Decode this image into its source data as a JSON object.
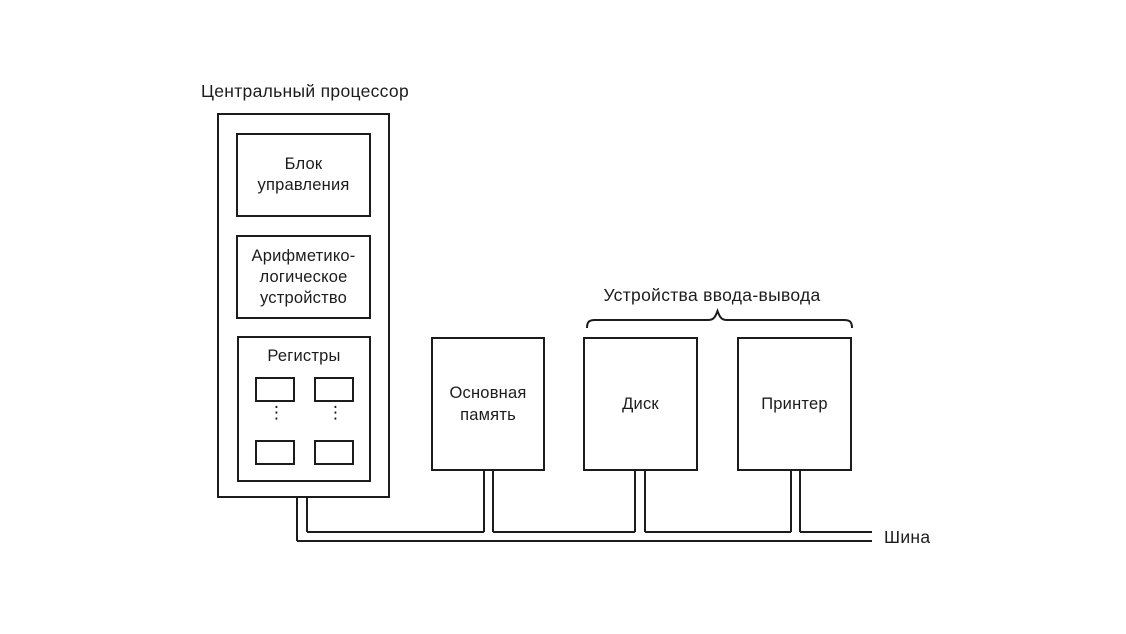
{
  "colors": {
    "ink": "#1c1c1c",
    "background": "#ffffff"
  },
  "cpu": {
    "title": "Центральный процессор",
    "control_unit": {
      "line1": "Блок",
      "line2": "управления"
    },
    "alu": {
      "line1": "Арифметико-",
      "line2": "логическое",
      "line3": "устройство"
    },
    "registers": {
      "title": "Регистры",
      "ellipsis_glyph": "⋮"
    }
  },
  "memory": {
    "line1": "Основная",
    "line2": "память"
  },
  "io_devices": {
    "group_label": "Устройства ввода-вывода",
    "disk_label": "Диск",
    "printer_label": "Принтер"
  },
  "bus": {
    "label": "Шина"
  }
}
